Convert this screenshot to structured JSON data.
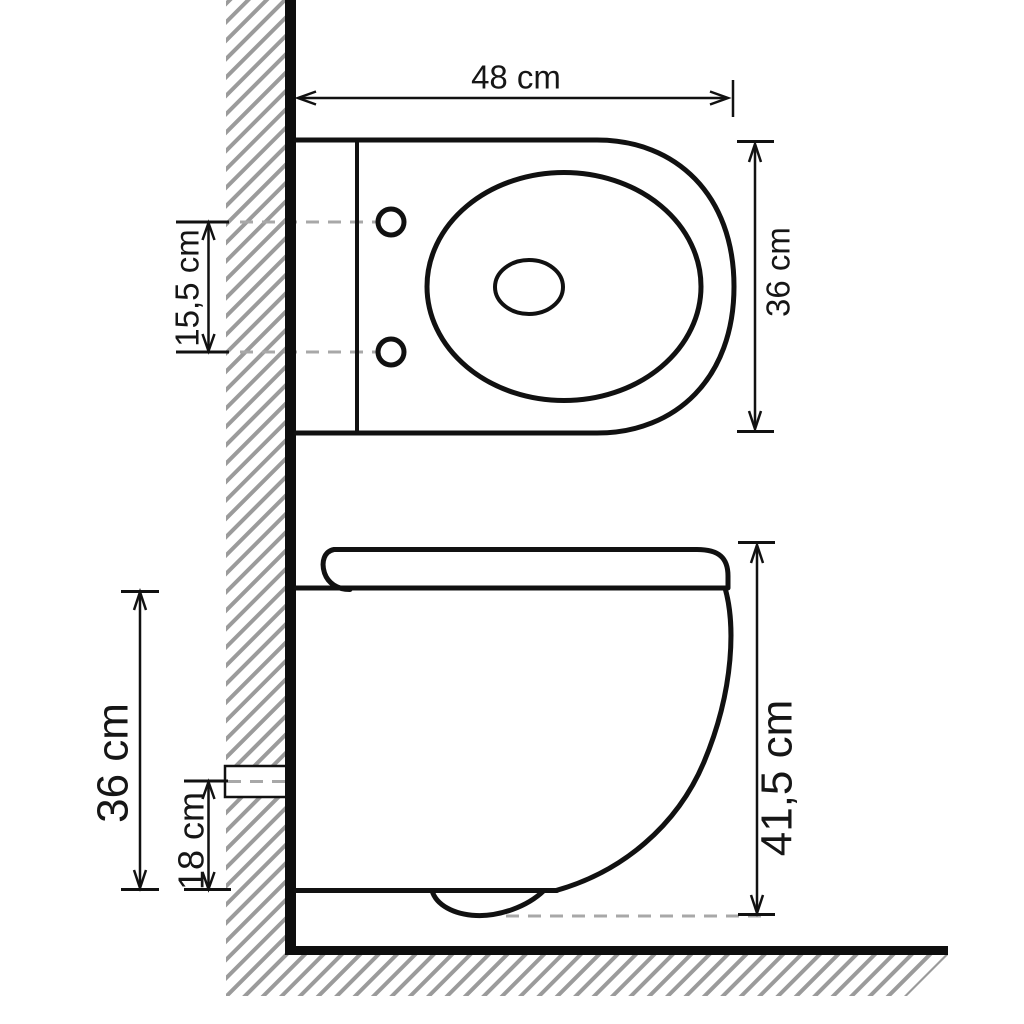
{
  "diagram": {
    "unit": "cm",
    "views": {
      "top_view": {
        "name": "top view"
      },
      "side_view": {
        "name": "side view"
      }
    },
    "dimensions": {
      "top_view": {
        "width": "48 cm",
        "depth": "36 cm",
        "hole_spacing": "15,5 cm"
      },
      "side_view": {
        "overall_height": "41,5 cm",
        "body_height": "36 cm",
        "drain_center_height": "18 cm"
      }
    },
    "colors": {
      "line": "#111111",
      "hatch": "#9b9b9b",
      "dashed_line": "#a8a8a8",
      "background": "#ffffff"
    }
  }
}
